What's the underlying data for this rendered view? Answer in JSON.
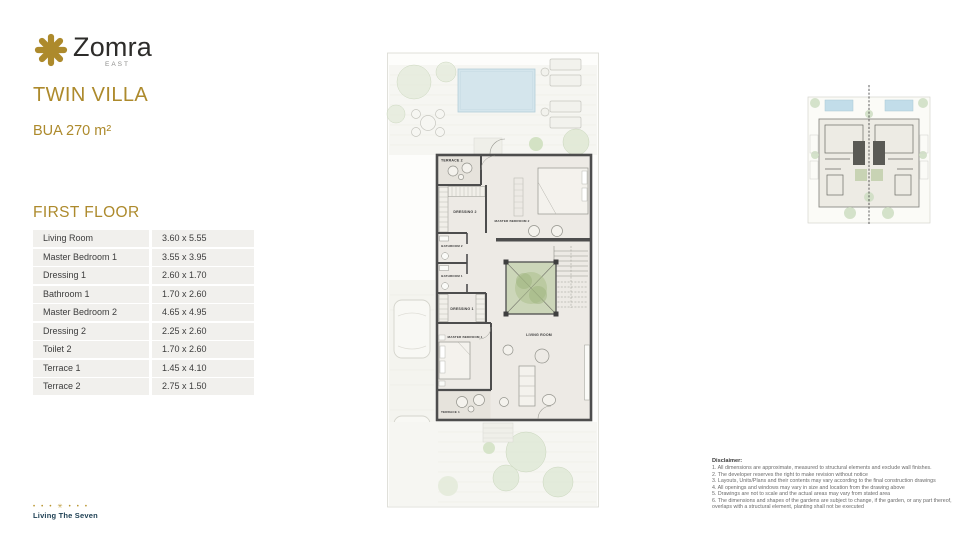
{
  "brand": {
    "name": "Zomra",
    "region": "EAST",
    "accent_color": "#AD8A2C",
    "footer": {
      "marks": "• • • ✳ • • •",
      "tagline": "Living The Seven"
    }
  },
  "header": {
    "unit_type": "TWIN VILLA",
    "bua": "BUA 270 m²"
  },
  "floor": {
    "heading": "FIRST FLOOR",
    "rooms": [
      {
        "name": "Living Room",
        "dimensions": "3.60 x 5.55"
      },
      {
        "name": "Master Bedroom 1",
        "dimensions": "3.55 x 3.95"
      },
      {
        "name": "Dressing 1",
        "dimensions": "2.60 x 1.70"
      },
      {
        "name": "Bathroom 1",
        "dimensions": "1.70 x 2.60"
      },
      {
        "name": "Master Bedroom 2",
        "dimensions": "4.65 x 4.95"
      },
      {
        "name": "Dressing 2",
        "dimensions": "2.25 x 2.60"
      },
      {
        "name": "Toilet 2",
        "dimensions": "1.70 x 2.60"
      },
      {
        "name": "Terrace 1",
        "dimensions": "1.45 x 4.10"
      },
      {
        "name": "Terrace 2",
        "dimensions": "2.75 x 1.50"
      }
    ]
  },
  "plan": {
    "labels": {
      "terrace2": "TERRACE 2",
      "dressing2": "DRESSING 2",
      "master_bedroom2": "MASTER BEDROOM 2",
      "bathroom2": "BATHROOM 2",
      "bathroom1": "BATHROOM 1",
      "dressing1": "DRESSING 1",
      "master_bedroom1": "MASTER BEDROOM 1",
      "living_room": "LIVING ROOM",
      "terrace1": "TERRACE 1"
    }
  },
  "disclaimer": {
    "title": "Disclaimer:",
    "lines": [
      "1. All dimensions are approximate, measured to structural elements and exclude wall finishes.",
      "2. The developer reserves the right to make revision without notice",
      "3. Layouts, Units/Plans and their contents may vary according to the final construction drawings",
      "4. All openings and windows may vary in size and location from the drawing above",
      "5. Drawings are not to scale and the actual areas may vary from stated area",
      "6. The dimensions and shapes of the gardens are subject to change, if the garden, or any part thereof, overlaps with a structural element, planting shall not be executed"
    ]
  }
}
